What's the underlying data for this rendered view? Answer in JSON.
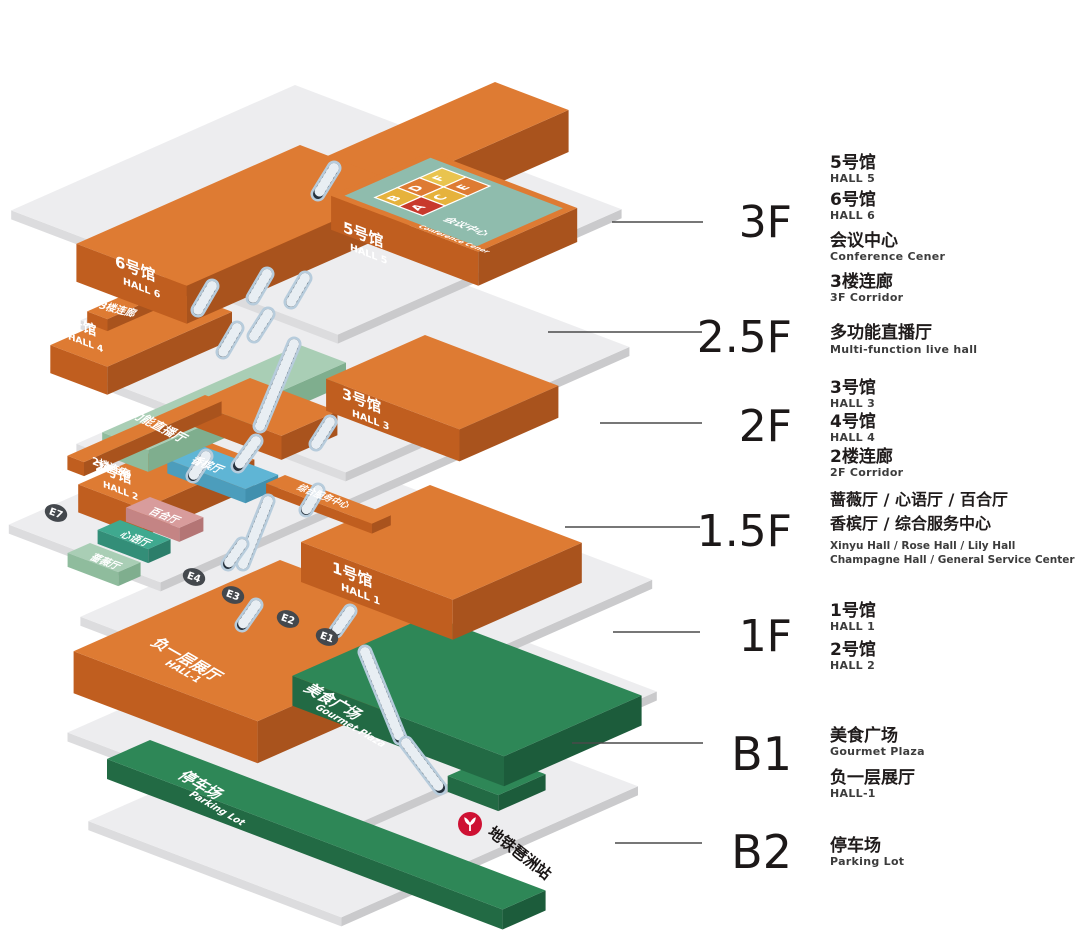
{
  "diagram": {
    "title": "exhibition-center-stacked-floor-map",
    "floors_panel": {
      "floors": [
        {
          "code": "3F",
          "items": [
            {
              "zh": "5号馆",
              "en": "HALL 5"
            },
            {
              "zh": "6号馆",
              "en": "HALL 6"
            },
            {
              "zh": "会议中心",
              "en": "Conference Cener"
            },
            {
              "zh": "3楼连廊",
              "en": "3F Corridor"
            }
          ]
        },
        {
          "code": "2.5F",
          "items": [
            {
              "zh": "多功能直播厅",
              "en": "Multi-function live hall"
            }
          ]
        },
        {
          "code": "2F",
          "items": [
            {
              "zh": "3号馆",
              "en": "HALL 3"
            },
            {
              "zh": "4号馆",
              "en": "HALL 4"
            },
            {
              "zh": "2楼连廊",
              "en": "2F Corridor"
            }
          ]
        },
        {
          "code": "1.5F",
          "items": [
            {
              "zh": "蔷薇厅 / 心语厅 / 百合厅",
              "en": "Xinyu Hall / Rose Hall / Lily Hall"
            },
            {
              "zh": "香槟厅 / 综合服务中心",
              "en": "Champagne Hall / General Service Center"
            }
          ]
        },
        {
          "code": "1F",
          "items": [
            {
              "zh": "1号馆",
              "en": "HALL 1"
            },
            {
              "zh": "2号馆",
              "en": "HALL 2"
            }
          ]
        },
        {
          "code": "B1",
          "items": [
            {
              "zh": "美食广场",
              "en": "Gourmet Plaza"
            },
            {
              "zh": "负一层展厅",
              "en": "HALL-1"
            }
          ]
        },
        {
          "code": "B2",
          "items": [
            {
              "zh": "停车场",
              "en": "Parking Lot"
            }
          ]
        }
      ]
    },
    "blocks": {
      "hall6": {
        "zh": "6号馆",
        "en": "HALL 6"
      },
      "hall5": {
        "zh": "5号馆",
        "en": "HALL 5"
      },
      "conference": {
        "zh": "会议中心",
        "en": "Conference Cener"
      },
      "corridor3": {
        "zh": "3楼连廊"
      },
      "hall4": {
        "zh": "4号馆",
        "en": "HALL 4"
      },
      "hall3": {
        "zh": "3号馆",
        "en": "HALL 3"
      },
      "corridor2": {
        "zh": "2楼连廊"
      },
      "multifunction": {
        "zh": "多功能直播厅"
      },
      "champagne": {
        "zh": "香槟厅"
      },
      "service": {
        "zh": "综合服务中心"
      },
      "lily": {
        "zh": "百合厅"
      },
      "xinyu": {
        "zh": "心语厅"
      },
      "rose": {
        "zh": "蔷薇厅"
      },
      "hall2": {
        "zh": "2号馆",
        "en": "HALL 2"
      },
      "hall1": {
        "zh": "1号馆",
        "en": "HALL 1"
      },
      "hallb1": {
        "zh": "负一层展厅",
        "en": "HALL-1"
      },
      "gourmet": {
        "zh": "美食广场",
        "en": "Gourmet Plaza"
      },
      "parking": {
        "zh": "停车场",
        "en": "Parking Lot"
      }
    },
    "conference_rooms": [
      "B",
      "D",
      "F",
      "A",
      "C",
      "E"
    ],
    "entrances": [
      "E1",
      "E2",
      "E3",
      "E4",
      "E7"
    ],
    "metro": {
      "label": "地铁琶洲站"
    },
    "colors": {
      "hall_orange": "#DE7B33",
      "plate_gray": "#EDEDEF",
      "green": "#2E8757",
      "sage": "#A9CEB5",
      "teal": "#3FA98F",
      "pink": "#D89C9C",
      "blue": "#5FB5D5",
      "conference_teal": "#8FBCAD",
      "room_yellow": "#E6B23C",
      "room_red": "#C8392C",
      "metro_red": "#CE1133",
      "badge_dark": "#44484D",
      "escalator_band": "#25313D",
      "escalator_casing": "#B7CCDC"
    }
  }
}
